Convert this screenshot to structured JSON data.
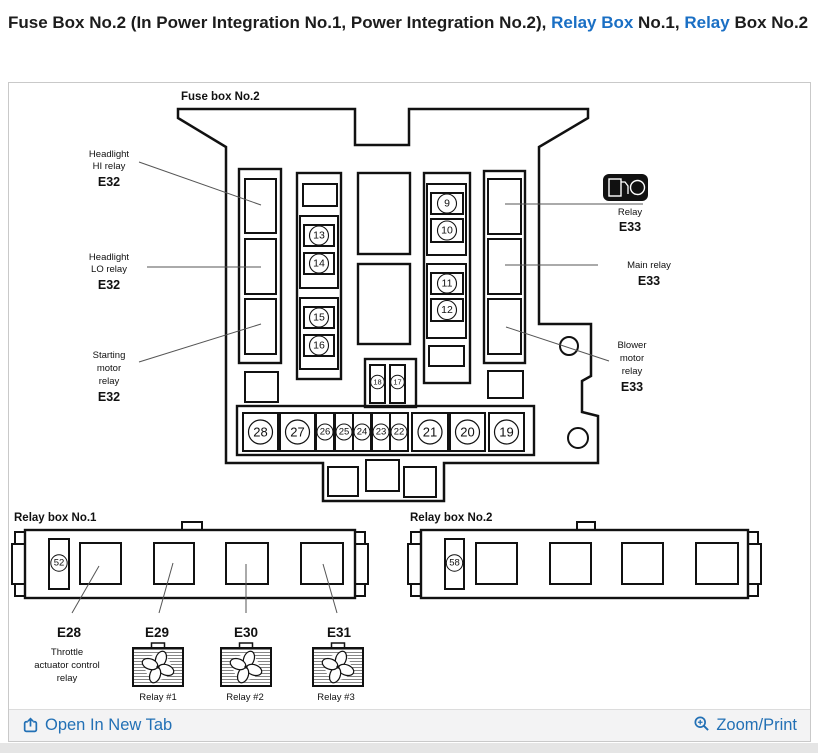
{
  "title": {
    "part1": "Fuse Box No.2 (In Power Integration No.1, Power Integration No.2), ",
    "link1": "Relay Box",
    "part2": " No.1, ",
    "link2": "Relay",
    "part3": " Box No.2"
  },
  "colors": {
    "title_link_blue": "#1a6fc4",
    "footer_link_blue": "#2270b5",
    "diagram_line": "#111111",
    "panel_border": "#c9c9c9",
    "footer_bg": "#f3f3f4"
  },
  "fusebox2": {
    "label": "Fuse box No.2",
    "left_labels": [
      {
        "lines": [
          "Headlight",
          "HI relay"
        ],
        "code": "E32"
      },
      {
        "lines": [
          "Headlight",
          "LO relay"
        ],
        "code": "E32"
      },
      {
        "lines": [
          "Starting",
          "motor",
          "relay"
        ],
        "code": "E32"
      }
    ],
    "right_labels": [
      {
        "lines": [
          "Relay"
        ],
        "code": "E33"
      },
      {
        "lines": [
          "Main relay"
        ],
        "code": "E33"
      },
      {
        "lines": [
          "Blower",
          "motor",
          "relay"
        ],
        "code": "E33"
      }
    ],
    "pump_icon": {
      "letters": [
        "F",
        "P"
      ]
    },
    "fuses": {
      "f9": "9",
      "f10": "10",
      "f11": "11",
      "f12": "12",
      "f13": "13",
      "f14": "14",
      "f15": "15",
      "f16": "16",
      "f17": "17",
      "f18": "18",
      "f19": "19",
      "f20": "20",
      "f21": "21",
      "f22": "22",
      "f23": "23",
      "f24": "24",
      "f25": "25",
      "f26": "26",
      "f27": "27",
      "f28": "28"
    }
  },
  "relaybox1": {
    "label": "Relay box No.1",
    "fuse": "52",
    "slots": [
      {
        "code": "E28",
        "desc": [
          "Throttle",
          "actuator control",
          "relay"
        ]
      },
      {
        "code": "E29",
        "caption": "Relay #1"
      },
      {
        "code": "E30",
        "caption": "Relay #2"
      },
      {
        "code": "E31",
        "caption": "Relay #3"
      }
    ]
  },
  "relaybox2": {
    "label": "Relay box No.2",
    "fuse": "58"
  },
  "footer": {
    "open_label": "Open In New Tab",
    "zoom_label": "Zoom/Print"
  }
}
